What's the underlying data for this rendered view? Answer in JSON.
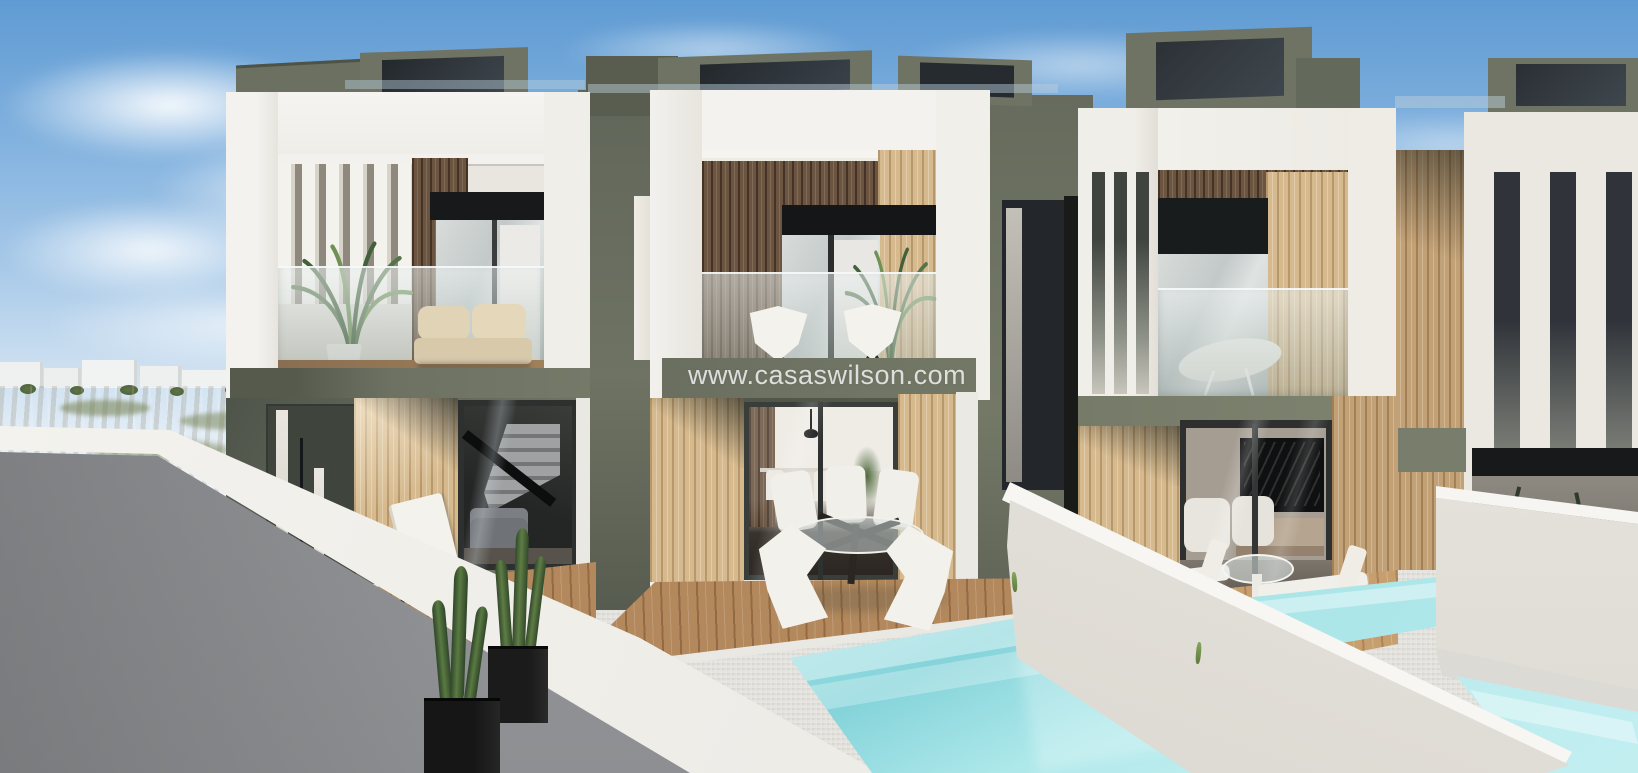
{
  "watermark": {
    "text": "www.casaswilson.com"
  },
  "scene": {
    "type": "architectural-3d-render",
    "description": "New-build modern two-storey terraced villas with wood-slat facades, olive-green accents, glass balconies, private plunge pools, cactus planters and sun terraces under a blue sky",
    "objects": [
      "sky",
      "clouds",
      "distant-village",
      "scrubland",
      "left-villa",
      "middle-villa",
      "right-villa",
      "partial-villa-right",
      "privacy-walls",
      "plunge-pools",
      "cactus-planters",
      "sun-loungers",
      "outdoor-dining-set",
      "palm-plants",
      "folding-chairs",
      "hammock-chair",
      "balcony-sofa",
      "staircase",
      "kitchen-interior",
      "tv-lounge-interior"
    ]
  },
  "palette": {
    "sky-top": "#5f9bd3",
    "sky-horizon": "#e9f1f7",
    "olive": "#6e7363",
    "olive-light": "#7c816f",
    "olive-dark": "#4b5046",
    "olive-deep": "#2f342c",
    "white-wall": "#f3f2ee",
    "cream-wall": "#ebe8e1",
    "wood-dark": "#6b5440",
    "wood-light": "#d6ba8e",
    "deck": "#b2885c",
    "glass": "#ccd2d1",
    "dark-opening": "#17191a",
    "terrain": "#c9b392",
    "terrain-green": "#75804f",
    "gray-wall": "#97999c",
    "patio": "#dedcd7",
    "water": "#85d4da",
    "water-light": "#c2eef0",
    "canvas": "#f4f2ec"
  }
}
